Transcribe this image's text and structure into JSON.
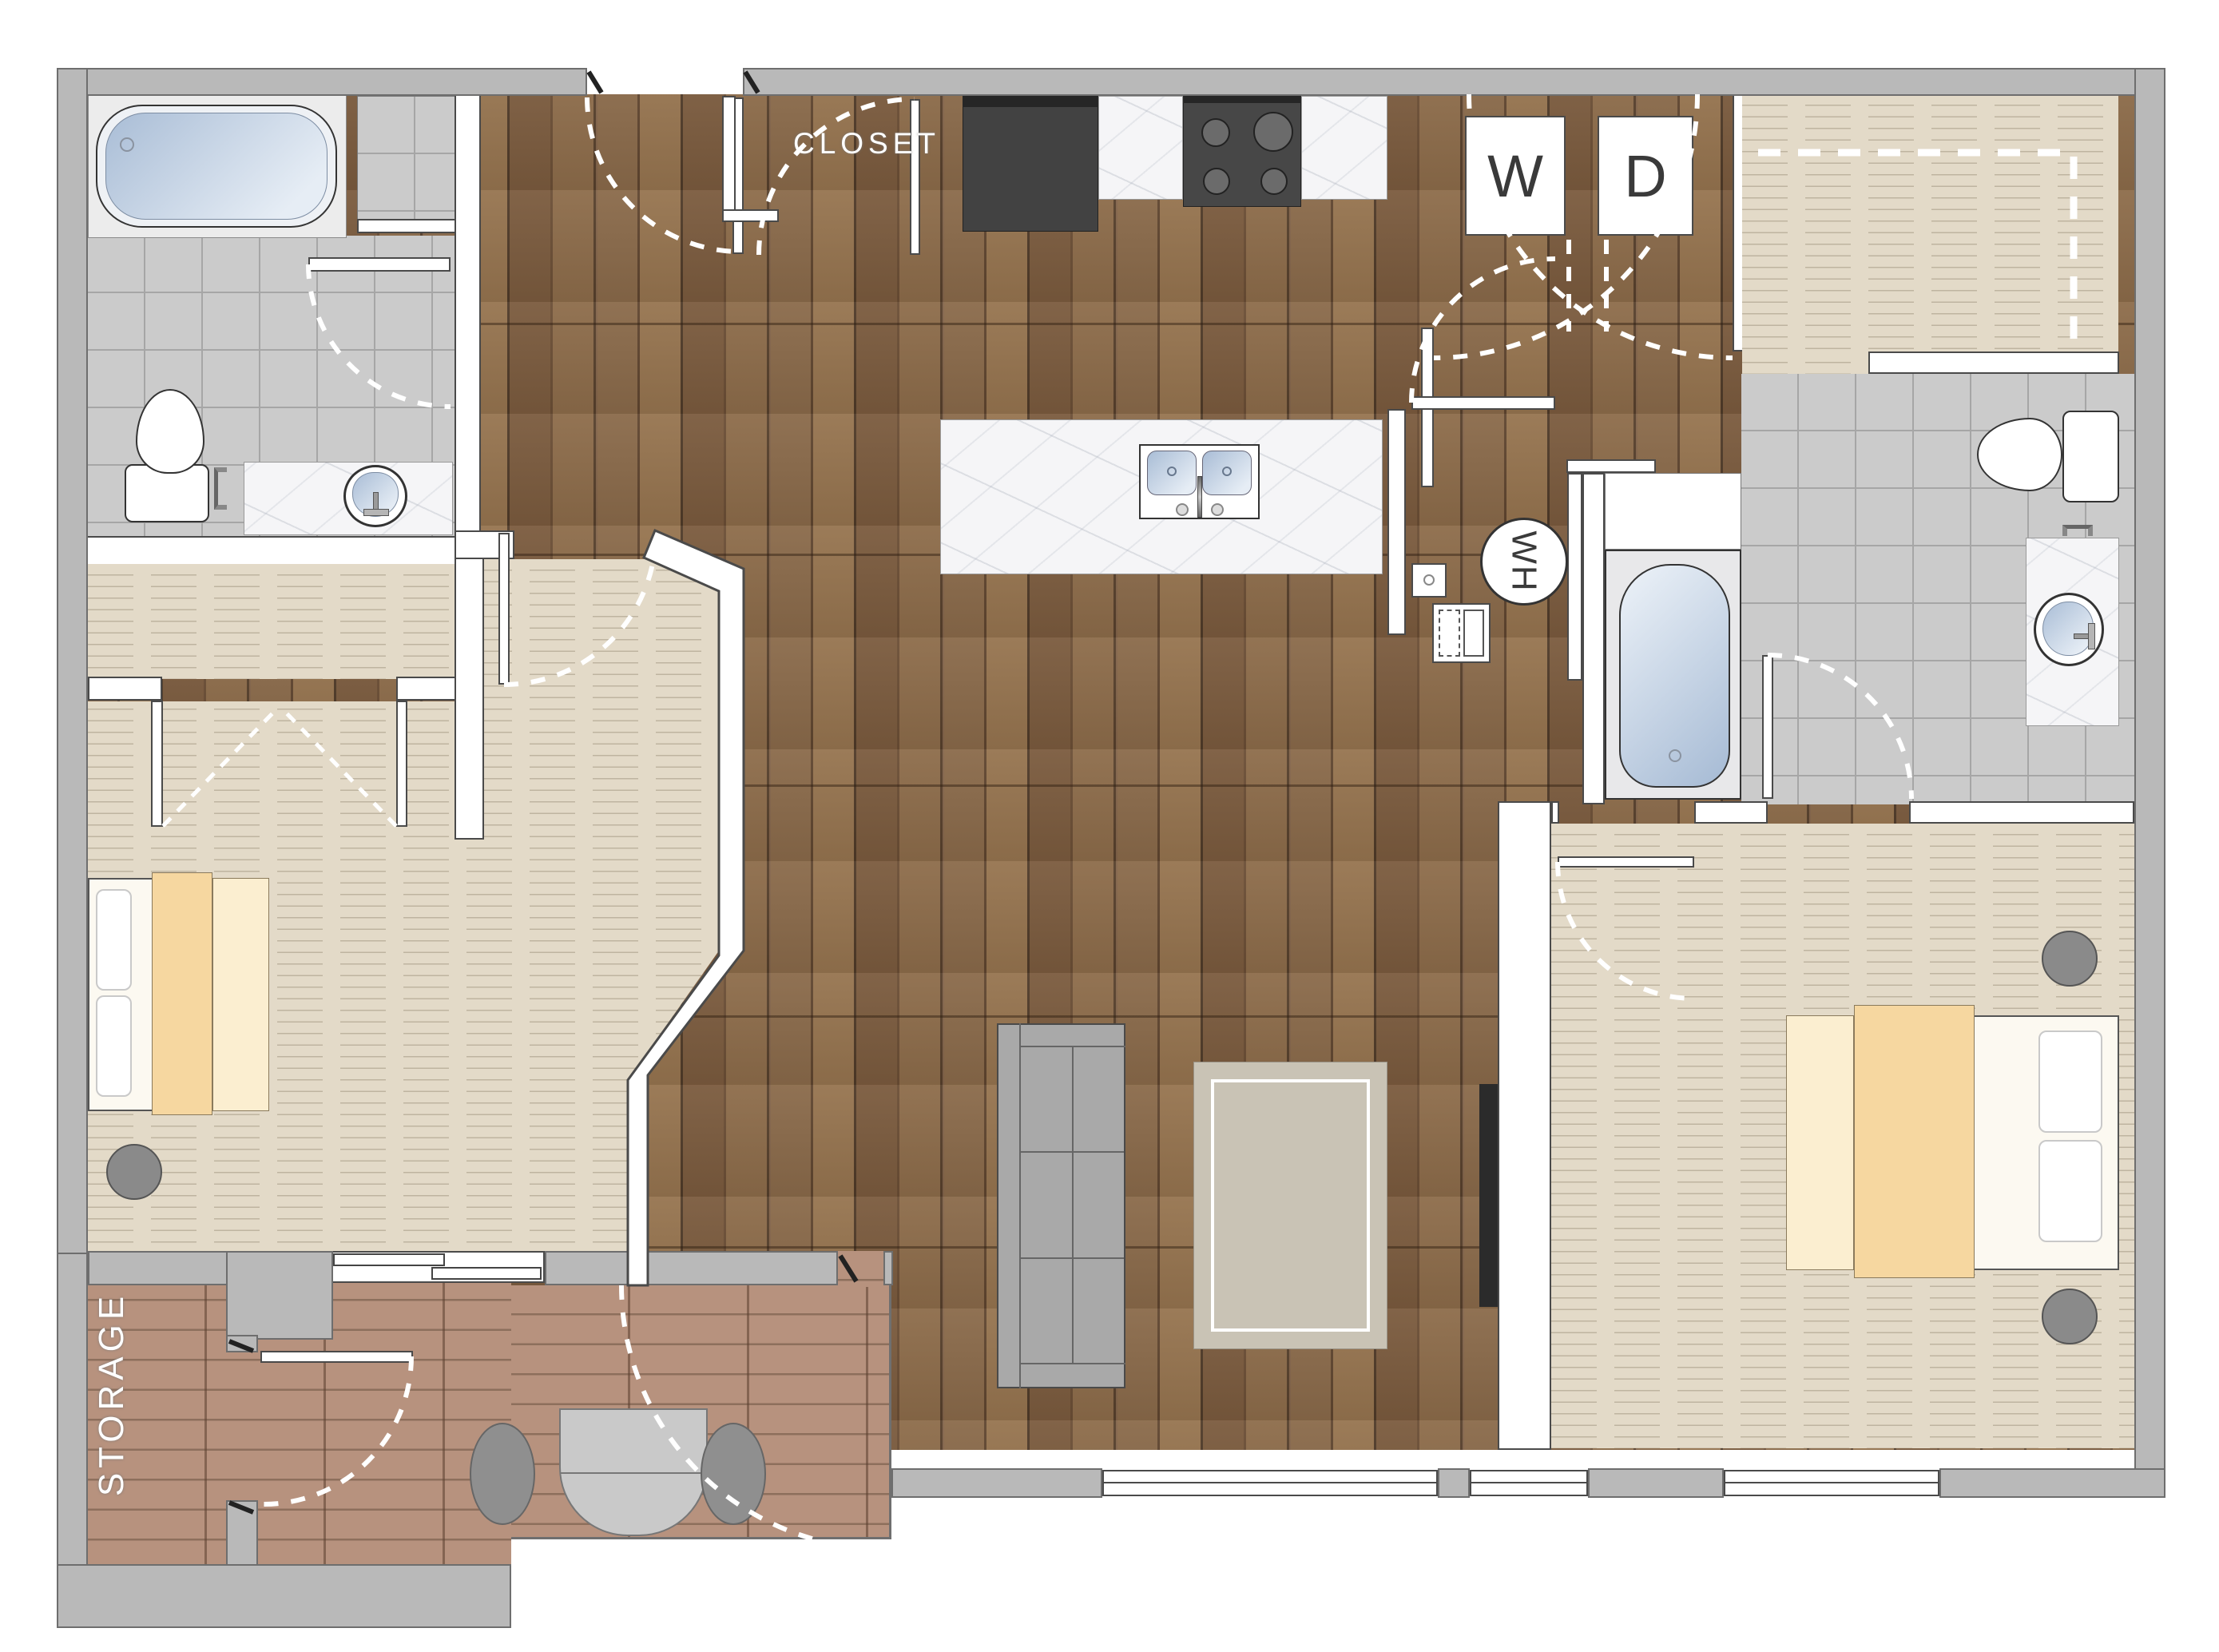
{
  "title": "Two-bedroom apartment floor plan",
  "labels": {
    "closet": "CLOSET",
    "storage": "STORAGE",
    "washer": "W",
    "dryer": "D",
    "water_heater": "WH"
  },
  "rooms": {
    "upper_left": "bathroom with tub, shower, toilet, vanity",
    "center_top": "kitchen with fridge, stove, counters, island with double sink",
    "top_right": "laundry with washer and dryer, walk-in closet, second bathroom",
    "left": "bedroom with closet and bed",
    "center": "living room with couch, rug and TV",
    "right": "second bedroom with bed",
    "bottom_left": "patio with storage room, table and chairs"
  },
  "colors": {
    "wood_floor": "#7d5f43",
    "carpet": "#e3dac8",
    "tile": "#cbcbcb",
    "brick_patio": "#b7927e",
    "exterior_wall": "#b9b9b9",
    "interior_wall": "#ffffff",
    "water_fixture": "#a9bdd6",
    "blanket": "#f6d7a0",
    "couch": "#a9a9a9",
    "rug": "#c9c3b5",
    "appliance_dark": "#424242",
    "outline": "#4a4a4a"
  }
}
